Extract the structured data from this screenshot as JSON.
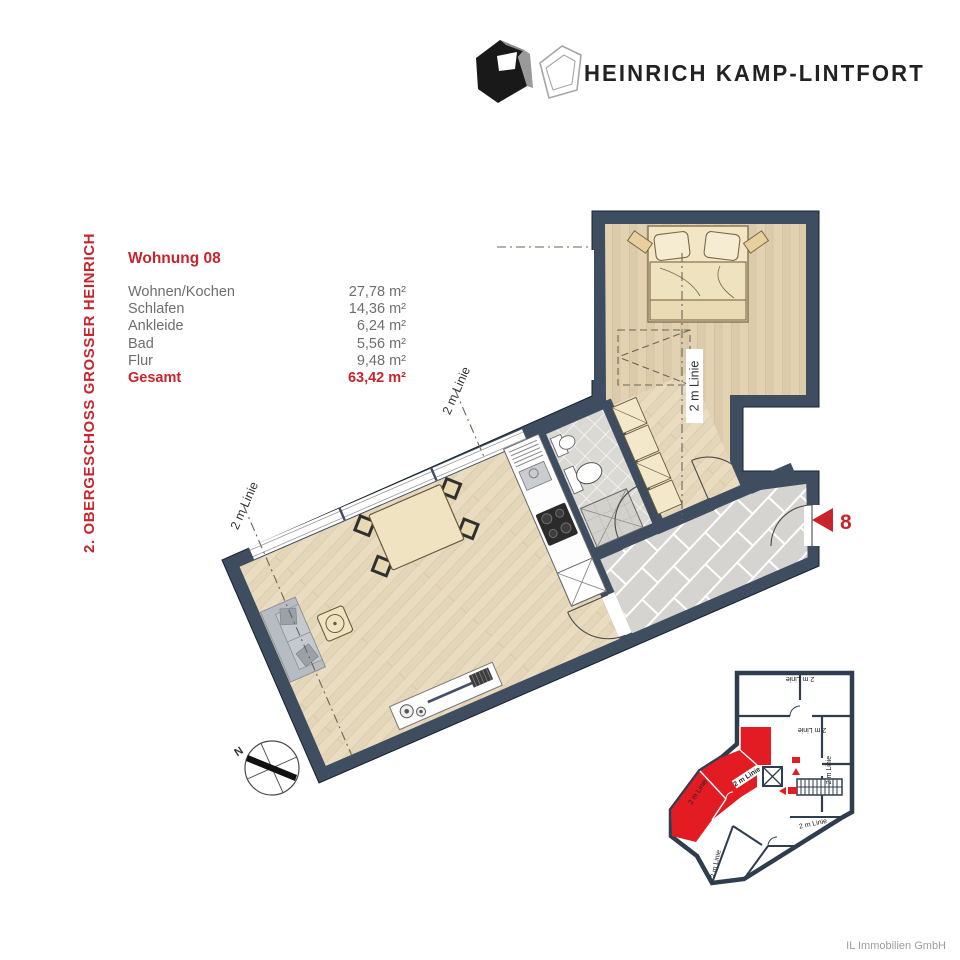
{
  "brand": {
    "name": "HEINRICH KAMP-LINTFORT"
  },
  "side_label": "2. OBERGESCHOSS GROSSER HEINRICH",
  "unit": {
    "title": "Wohnung 08",
    "rooms": [
      {
        "label": "Wohnen/Kochen",
        "area": "27,78 m²"
      },
      {
        "label": "Schlafen",
        "area": "14,36 m²"
      },
      {
        "label": "Ankleide",
        "area": "6,24 m²"
      },
      {
        "label": "Bad",
        "area": "5,56 m²"
      },
      {
        "label": "Flur",
        "area": "9,48 m²"
      }
    ],
    "total": {
      "label": "Gesamt",
      "area": "63,42 m²"
    }
  },
  "plan": {
    "height_line_label": "2 m Linie",
    "unit_number": "8",
    "compass": "N"
  },
  "footer": "IL Immobilien GmbH",
  "colors": {
    "accent_red": "#c9242b",
    "map_red": "#e31c23",
    "wall": "#3e4d60",
    "wood_living": "#e4d6b8",
    "wood_bedroom": "#dccbaa",
    "tile_gray": "#d6d4d0",
    "text_gray": "#6e6e6e"
  }
}
